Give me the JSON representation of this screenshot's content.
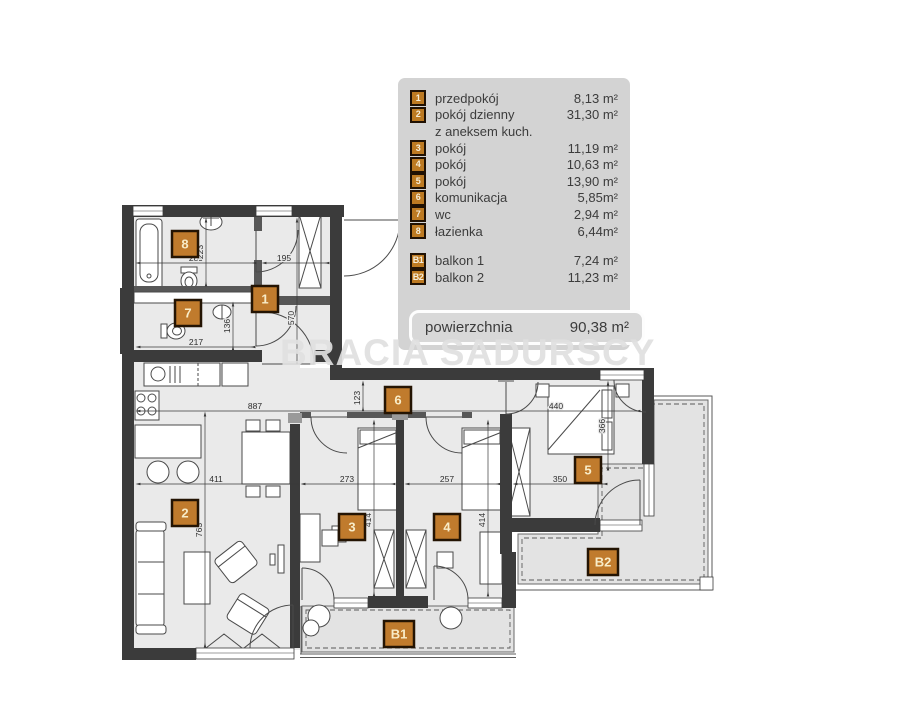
{
  "watermark": "BRACIA SADURSCY",
  "legend": {
    "rooms": [
      {
        "id": "1",
        "name": "przedpokój",
        "area": "8,13 m²"
      },
      {
        "id": "2",
        "name": "pokój dzienny",
        "name2": "z aneksem kuch.",
        "area": "31,30 m²"
      },
      {
        "id": "3",
        "name": "pokój",
        "area": "11,19 m²"
      },
      {
        "id": "4",
        "name": "pokój",
        "area": "10,63 m²"
      },
      {
        "id": "5",
        "name": "pokój",
        "area": "13,90 m²"
      },
      {
        "id": "6",
        "name": "komunikacja",
        "area": "5,85m²"
      },
      {
        "id": "7",
        "name": "wc",
        "area": "2,94 m²"
      },
      {
        "id": "8",
        "name": "łazienka",
        "area": "6,44m²"
      }
    ],
    "balconies": [
      {
        "id": "B1",
        "name": "balkon 1",
        "area": "7,24 m²"
      },
      {
        "id": "B2",
        "name": "balkon 2",
        "area": "11,23 m²"
      }
    ],
    "total_label": "powierzchnia",
    "total_area": "90,38 m²"
  },
  "plan": {
    "badges": [
      {
        "id": "1",
        "x": 265,
        "y": 299
      },
      {
        "id": "2",
        "x": 185,
        "y": 513
      },
      {
        "id": "3",
        "x": 352,
        "y": 527
      },
      {
        "id": "4",
        "x": 447,
        "y": 527
      },
      {
        "id": "5",
        "x": 588,
        "y": 470
      },
      {
        "id": "6",
        "x": 398,
        "y": 400
      },
      {
        "id": "7",
        "x": 188,
        "y": 313
      },
      {
        "id": "8",
        "x": 185,
        "y": 244
      },
      {
        "id": "B1",
        "x": 399,
        "y": 634,
        "wide": true
      },
      {
        "id": "B2",
        "x": 603,
        "y": 562,
        "wide": true
      }
    ],
    "dimensions": [
      {
        "t": "289",
        "x": 196,
        "y": 261
      },
      {
        "t": "223",
        "x": 203,
        "y": 252,
        "r": true
      },
      {
        "t": "195",
        "x": 284,
        "y": 261
      },
      {
        "t": "570",
        "x": 294,
        "y": 318,
        "r": true
      },
      {
        "t": "136",
        "x": 230,
        "y": 326,
        "r": true
      },
      {
        "t": "217",
        "x": 196,
        "y": 345
      },
      {
        "t": "887",
        "x": 255,
        "y": 409
      },
      {
        "t": "123",
        "x": 360,
        "y": 398,
        "r": true
      },
      {
        "t": "411",
        "x": 216,
        "y": 482
      },
      {
        "t": "273",
        "x": 347,
        "y": 482
      },
      {
        "t": "257",
        "x": 447,
        "y": 482
      },
      {
        "t": "350",
        "x": 560,
        "y": 482
      },
      {
        "t": "763",
        "x": 202,
        "y": 530,
        "r": true
      },
      {
        "t": "414",
        "x": 371,
        "y": 520,
        "r": true
      },
      {
        "t": "414",
        "x": 485,
        "y": 520,
        "r": true
      },
      {
        "t": "440",
        "x": 556,
        "y": 409
      },
      {
        "t": "366",
        "x": 605,
        "y": 426,
        "r": true
      }
    ]
  },
  "colors": {
    "badge_fill": "#c07b2d",
    "badge_border": "#241403",
    "badge_text": "#f8ecc8",
    "wall": "#3b3b3b",
    "floor": "#eaeaea",
    "balcony": "#e3e3e3",
    "legend_bg": "#d3d3d3"
  }
}
